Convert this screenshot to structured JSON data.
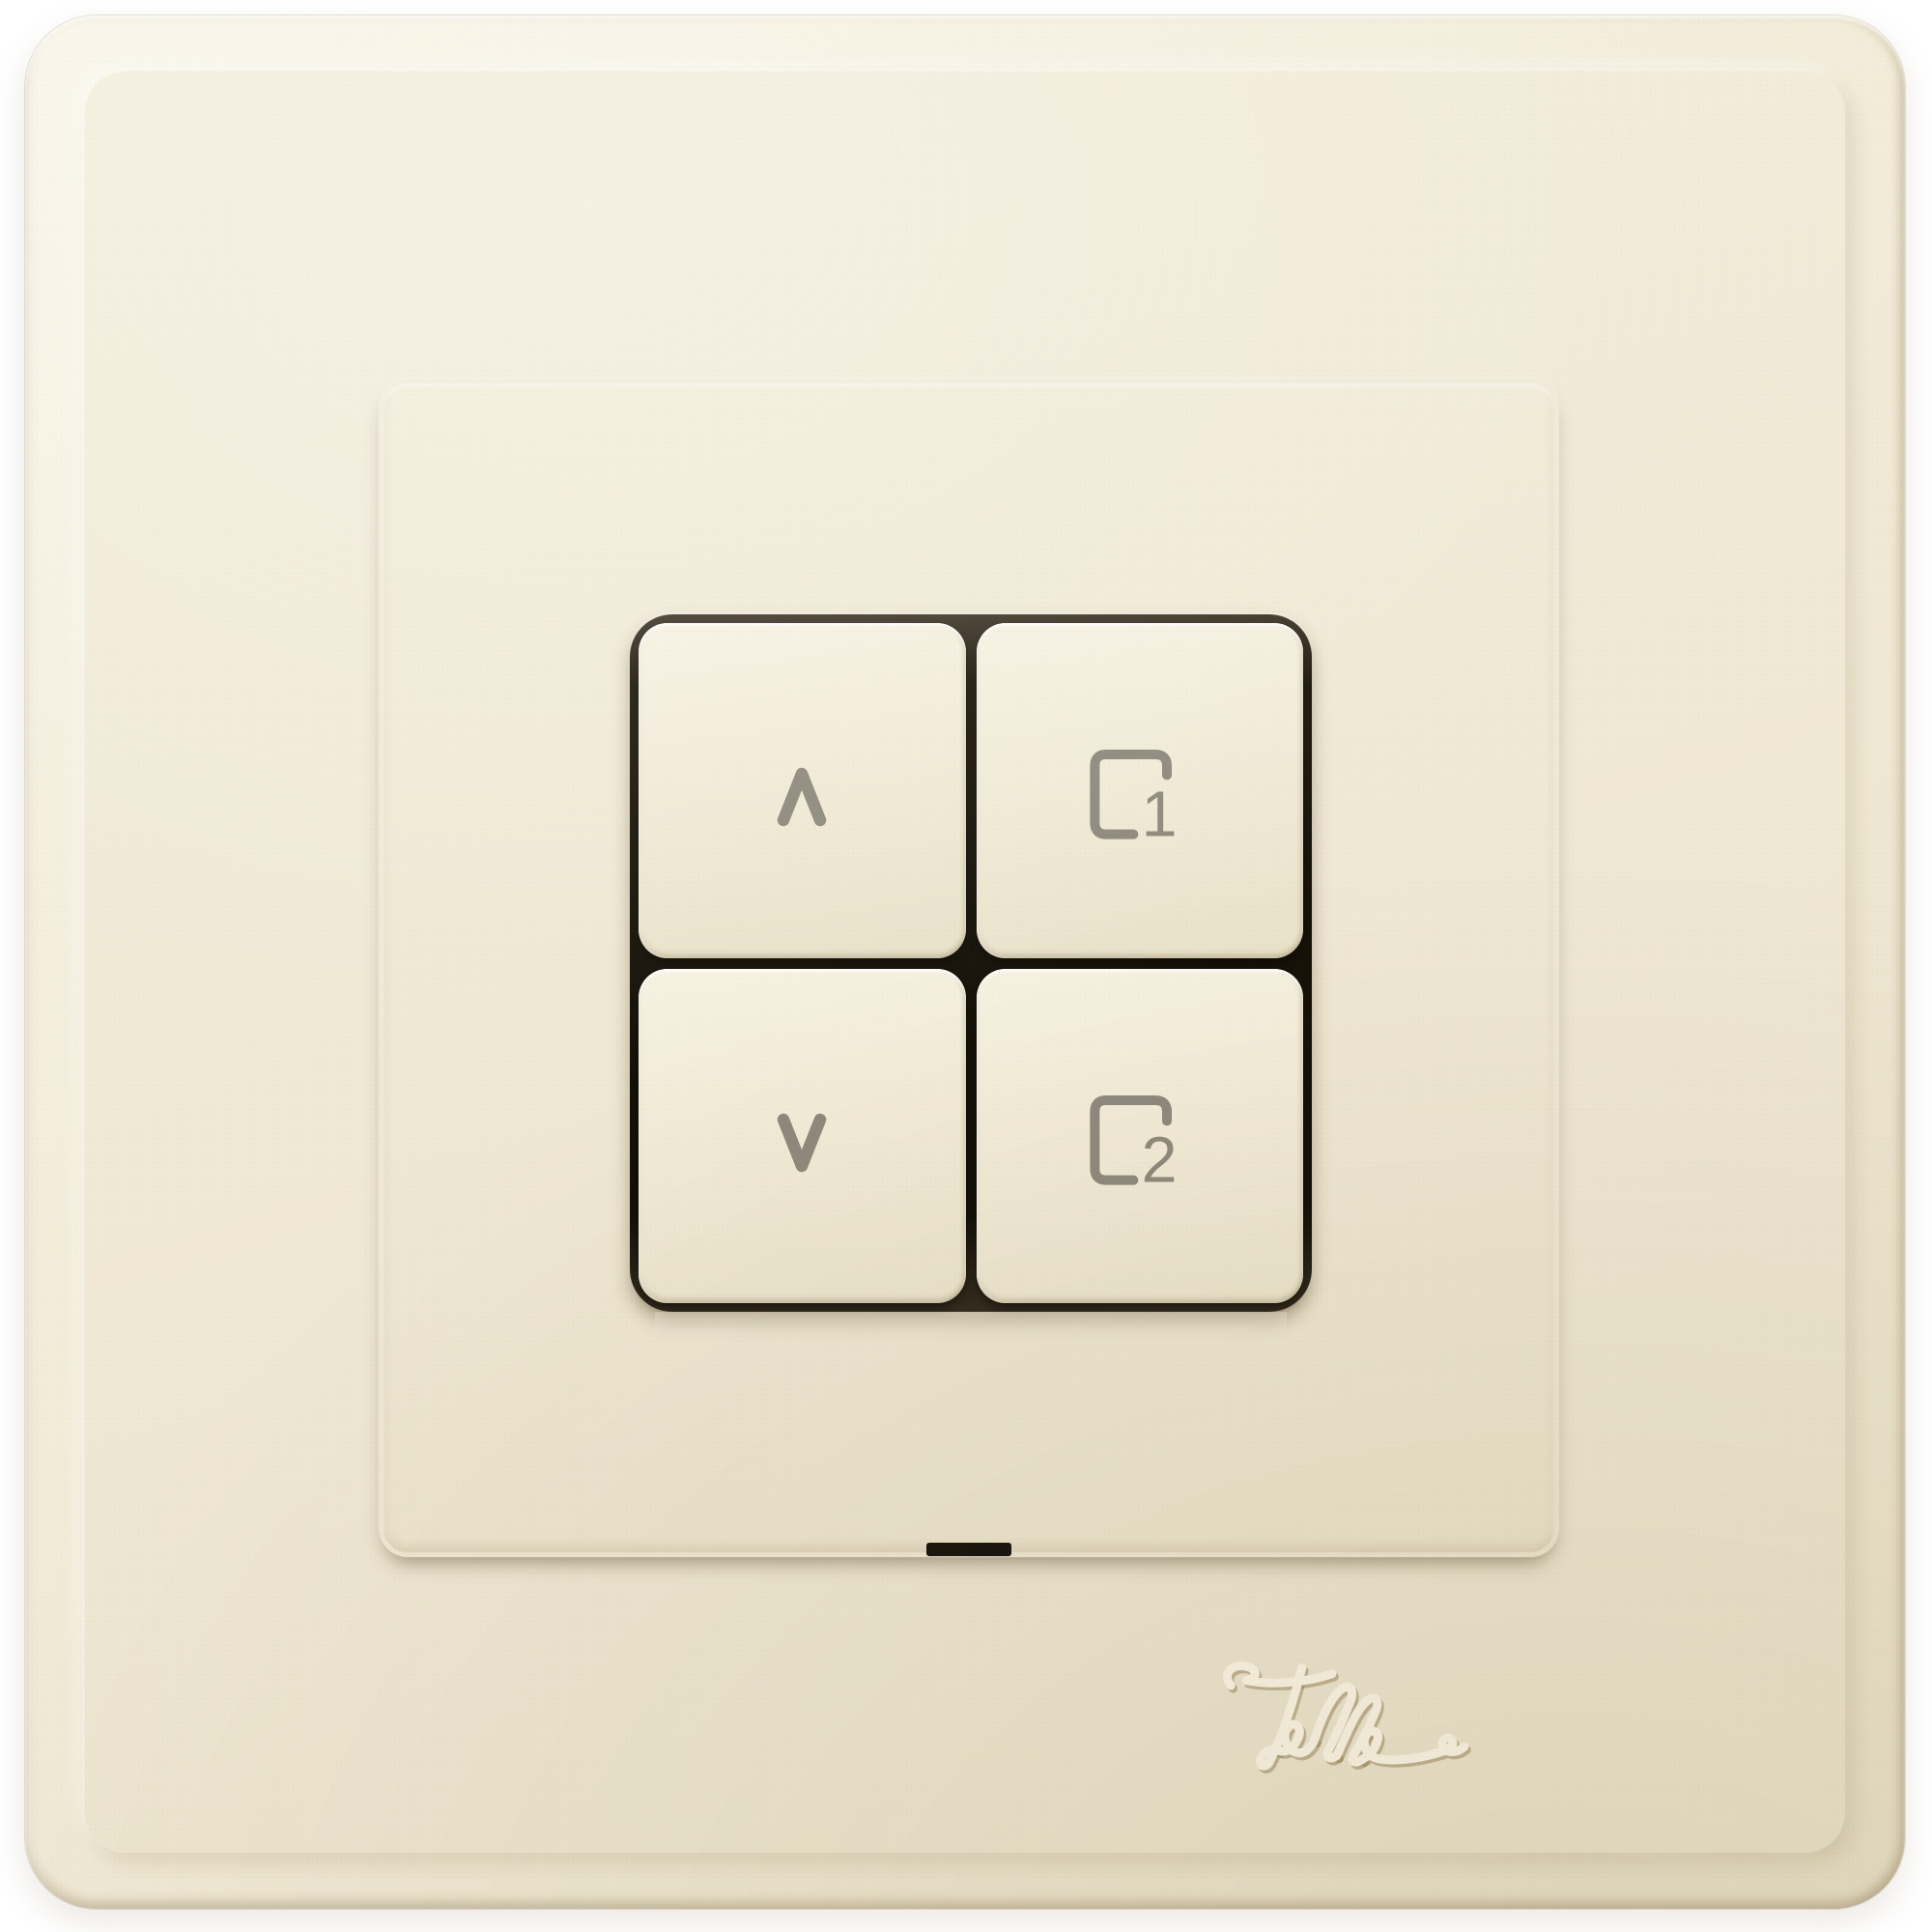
{
  "device": {
    "type": "4-button flush wall pushbutton switch",
    "brand": "Feller",
    "finish": "cream ivory plastic"
  },
  "logo": {
    "text": "Feller",
    "icon": "feller-signature-logo"
  },
  "buttons": {
    "up": {
      "icon": "chevron-up-icon",
      "number": ""
    },
    "scene1": {
      "icon": "scene-square-icon",
      "number": "1"
    },
    "down": {
      "icon": "chevron-down-icon",
      "number": ""
    },
    "scene2": {
      "icon": "scene-square-icon",
      "number": "2"
    }
  },
  "colors": {
    "background": "#ffffff",
    "plate_cream": "#f0e9d5",
    "bevel_highlight": "#f7f2e1",
    "seam_dark": "#1c1710",
    "icon_gray": "#8e897c",
    "logo_emboss": "#f9f4e2"
  }
}
